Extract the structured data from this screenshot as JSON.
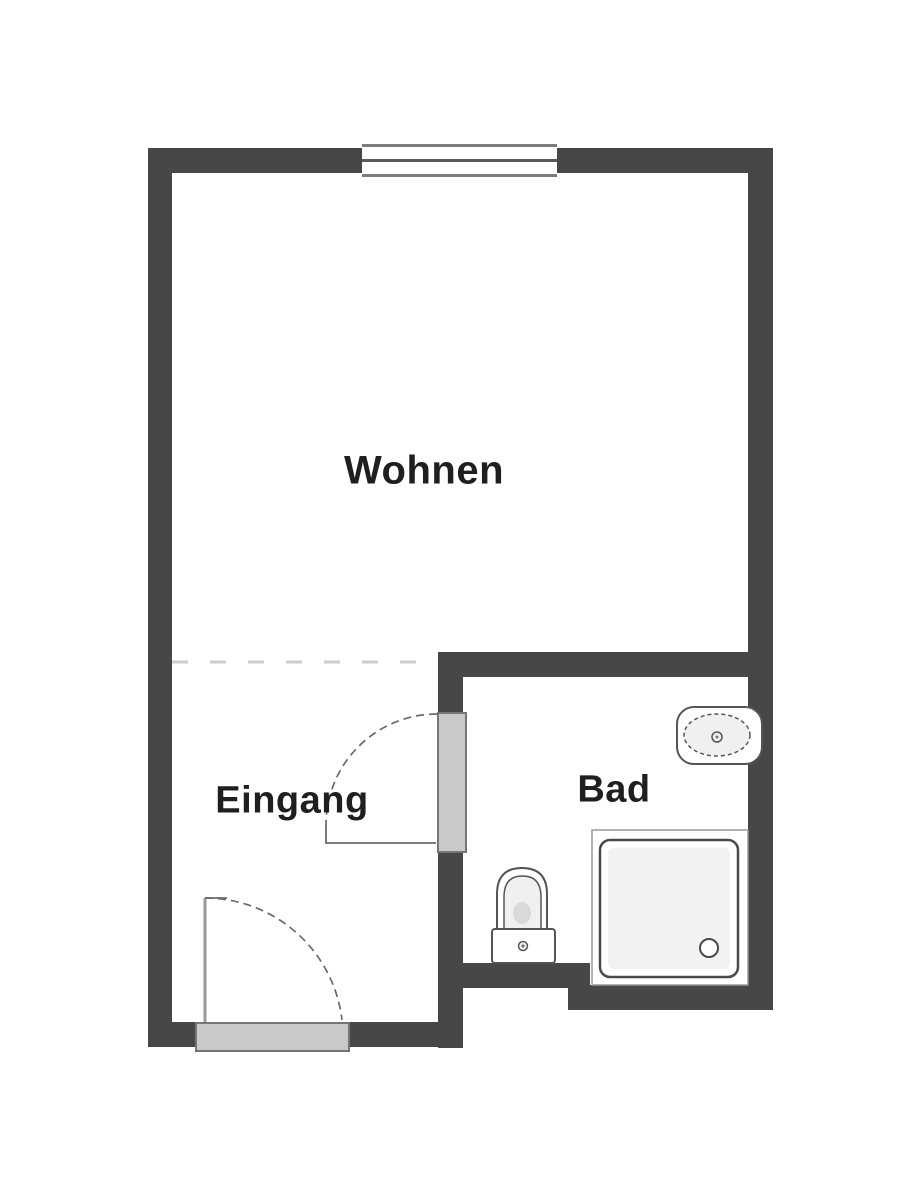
{
  "diagram_type": "floor-plan",
  "rooms": {
    "wohnen": {
      "label": "Wohnen"
    },
    "eingang": {
      "label": "Eingang"
    },
    "bad": {
      "label": "Bad"
    }
  },
  "fixtures": [
    {
      "name": "window",
      "location": "top wall"
    },
    {
      "name": "interior-door",
      "location": "wall between Eingang and Bad"
    },
    {
      "name": "entrance-door",
      "location": "bottom wall of Eingang"
    },
    {
      "name": "toilet",
      "location": "Bad"
    },
    {
      "name": "sink",
      "location": "Bad, right wall"
    },
    {
      "name": "shower",
      "location": "Bad, bottom right corner"
    }
  ],
  "colors": {
    "background": "#ffffff",
    "wall": "#474747",
    "door_panel": "#c9c9c9",
    "door_panel_border": "#757575",
    "fixture_outline": "#555555",
    "window_line": "#7d7d7d",
    "dashed_divider": "#cccccc",
    "label_text": "#1f1f1f"
  }
}
